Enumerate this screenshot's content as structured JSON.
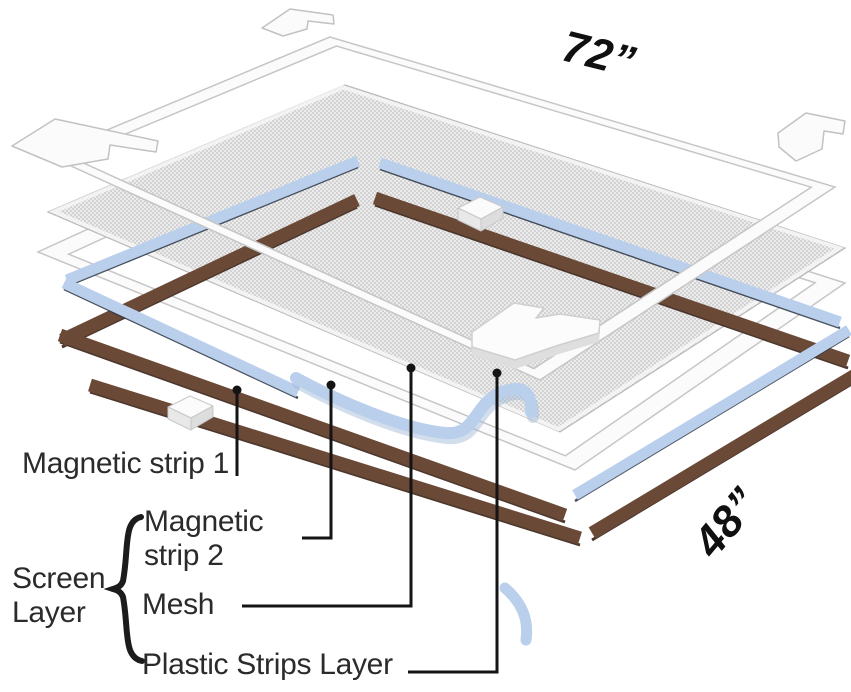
{
  "diagram": {
    "title": "Magnetic screen exploded layers diagram",
    "dimensions": {
      "width_label": "72”",
      "height_label": "48”"
    },
    "labels": {
      "magnetic_strip_1": "Magnetic strip 1",
      "magnetic_strip_2": "Magnetic strip 2",
      "screen_layer": "Screen Layer",
      "mesh": "Mesh",
      "plastic_strips_layer": "Plastic Strips Layer"
    },
    "colors": {
      "mesh_background": "#ececec",
      "mesh_dot": "#d2d2d2",
      "magnetic_strip_2_blue": "#b9cfec",
      "magnetic_strip_2_edge": "#2a3442",
      "magnetic_strip_1_brown": "#6b4937",
      "magnetic_strip_1_edge": "#3a2318",
      "plastic_frame_white": "#fbfbfb",
      "frame_stroke": "#c6c6c6",
      "leader_line": "#141414",
      "label_text": "#2b2b2b"
    }
  }
}
